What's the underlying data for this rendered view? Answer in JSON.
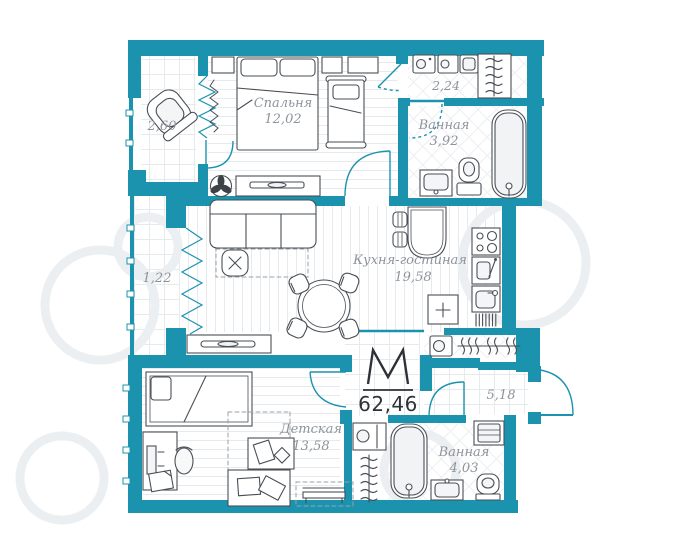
{
  "plan": {
    "type": "apartment-floorplan",
    "total": {
      "logo_letter": "M",
      "area": "62,46"
    },
    "rooms": {
      "bedroom": {
        "name": "Спальня",
        "area": "12,02"
      },
      "balcony_top": {
        "name": "",
        "area": "2,60"
      },
      "hallway_top": {
        "name": "",
        "area": "2,24"
      },
      "bathroom_top": {
        "name": "Ванная",
        "area": "3,92"
      },
      "balcony_left": {
        "name": "",
        "area": "1,22"
      },
      "kitchen_living": {
        "name": "Кухня-гостиная",
        "area": "19,58"
      },
      "children": {
        "name": "Детская",
        "area": "13,58"
      },
      "hall_entry": {
        "name": "",
        "area": "5,18"
      },
      "bathroom_bottom": {
        "name": "Ванная",
        "area": "4,03"
      }
    },
    "colors": {
      "wall": "#1b93af",
      "label": "#8e949c",
      "dark_text": "#2e3237",
      "furniture_line": "#4a4f56",
      "floor_line": "#e7eaec",
      "watermark": "#eceff1"
    }
  }
}
